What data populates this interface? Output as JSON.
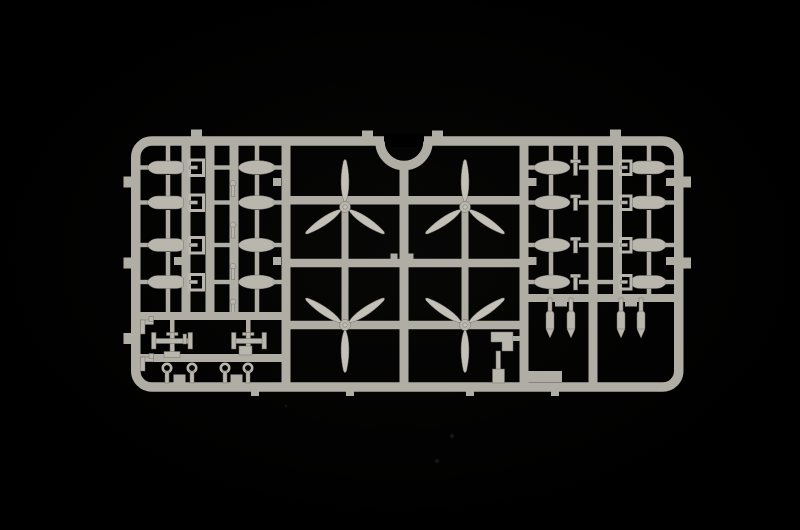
{
  "scene": {
    "description": "Photograph of a light grey injection-moulded plastic model kit sprue (parts frame) lying on a black background",
    "subject": "model kit sprue with aircraft armament and propeller parts",
    "background": "plain black with faint dust specks"
  },
  "colors": {
    "bg": "#000000",
    "sprue": "#b0ada4",
    "part": "#b9b6ad",
    "blade": "#c3c0b7",
    "edge": "#72706a",
    "speck": "#161614"
  },
  "sprue": {
    "frame": {
      "shape": "rounded rectangle runner frame",
      "notch": "semicircular cutout at top centre",
      "gate_tabs": "small square tabs on outer edges (top, left, right) and below bottom rail"
    },
    "inventory": {
      "three_blade_propellers": 4,
      "finned_bombs_pointed": 8,
      "streamlined_bombs_oval": 8,
      "small_hanging_bombs": 4,
      "fin_brackets": 8,
      "fuze_pins": 4,
      "t_pins": 4,
      "bomb_racks": 2,
      "eyelet_pins": 4,
      "hook_brackets": 2,
      "mount_block": 1
    },
    "layout": {
      "left": "two ladders of four bombs each plus fin brackets",
      "centre": "2x2 grid of three-blade propellers around a central runner under the notch",
      "right": "two ladders of four bombs each plus four small bombs hanging below",
      "bottom_left": "box with bomb racks, hooks and four eyelet pins"
    }
  }
}
